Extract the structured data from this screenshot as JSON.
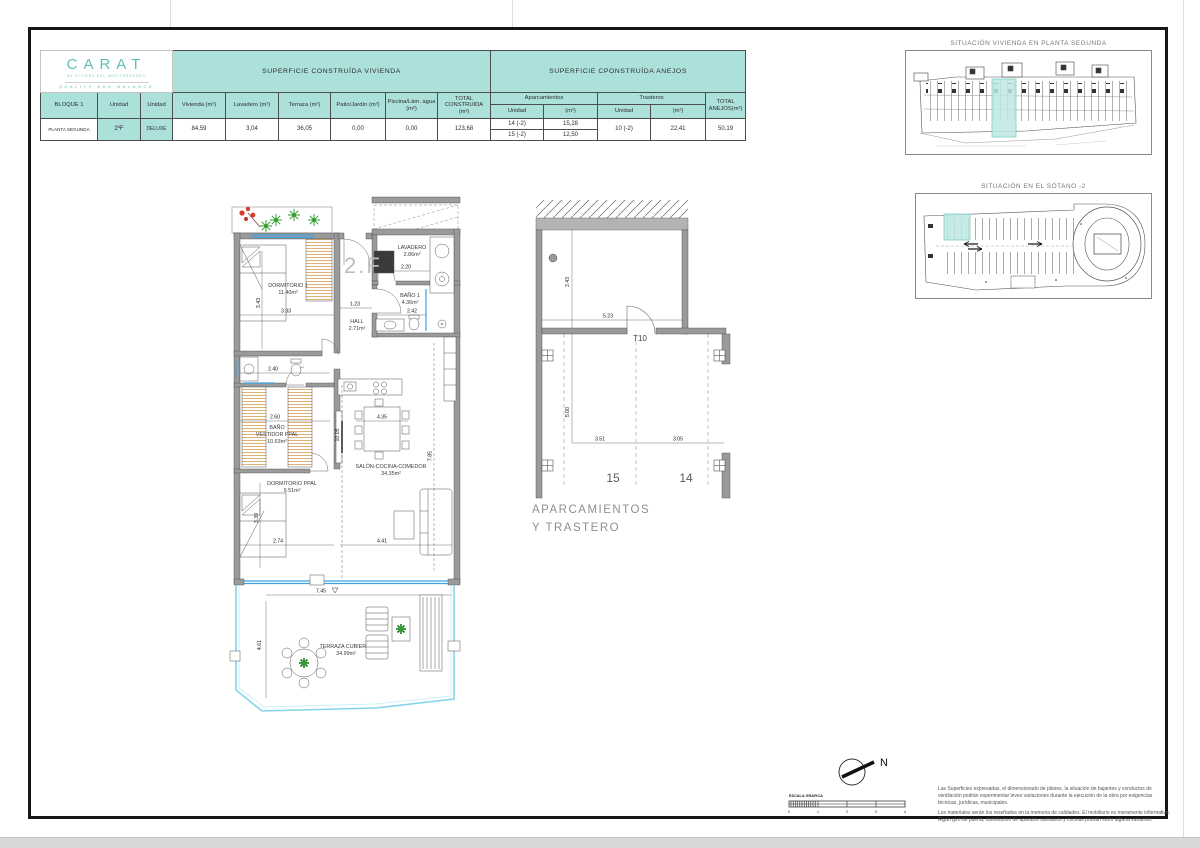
{
  "brand": {
    "name": "CARAT",
    "tagline": "BY RIVIERA DEL MEDITERRÁNEO",
    "motto": "QUALITY AND BALANCE"
  },
  "area_table": {
    "vivienda_title": "SUPERFICIE CONSTRUÍDA VIVIENDA",
    "anejos_title": "SUPERFICIE CPONSTRUÍDA ANEJOS",
    "headers": {
      "bloque": "BLOQUE 1",
      "unidad_a": "Unidad",
      "unidad_b": "Unidad",
      "vivienda": "Vivienda (m²)",
      "lavadero": "Lavadero (m²)",
      "terraza": "Terraza (m²)",
      "patio": "Patio/Jardín (m²)",
      "piscina": "Piscina/Lám. agua (m²)",
      "total_construida": "TOTAL CONSTRUIDA (m²)",
      "aparcamientos": "Aparcamientos",
      "trasteros": "Trasteros",
      "unidad": "Unidad",
      "m2": "(m²)",
      "total_anejos": "TOTAL ANEJOS(m²)"
    },
    "row": {
      "planta": "PLANTA SEGUNDA",
      "unidad": "2ºF",
      "tipo": "DELUXE",
      "vivienda": "84,59",
      "lavadero": "3,04",
      "terraza": "36,05",
      "patio": "0,00",
      "piscina": "0,00",
      "total_construida": "123,68",
      "aparcamiento1_unidad": "14 (-2)",
      "aparcamiento1_m2": "15,28",
      "aparcamiento2_unidad": "15 (-2)",
      "aparcamiento2_m2": "12,50",
      "trastero_unidad": "10 (-2)",
      "trastero_m2": "22,41",
      "total_anejos": "50,19"
    }
  },
  "floor_plan": {
    "unit_label": "2.F",
    "rooms": {
      "dormitorio1": {
        "name": "DORMITORIO 1",
        "area": "11.40m²"
      },
      "lavadero": {
        "name": "LAVADERO",
        "area": "2.86m²"
      },
      "bano1": {
        "name": "BAÑO 1",
        "area": "4.36m²"
      },
      "hall": {
        "name": "HALL",
        "area": "2.71m²"
      },
      "bano_vestidor": {
        "line1": "BAÑO",
        "line2": "VESTIDOR PPAL",
        "area": "10.63m²"
      },
      "dormitorio_ppal": {
        "name": "DORMITORIO PPAL",
        "area": "9.51m²"
      },
      "salon": {
        "name": "SALÓN-COCINA-COMEDOR",
        "area": "34.35m²"
      },
      "terraza": {
        "name": "TERRAZA CUBIERTA",
        "area": "34.99m²"
      }
    },
    "dims": {
      "dorm1_depth": "3.43",
      "dorm1_width": "3.33",
      "hall_width": "1.23",
      "lavadero_width": "2.20",
      "bano1_width": "2.42",
      "pasillo_width": "2.40",
      "vestidor_width": "2.60",
      "salon_depth": "10.05",
      "cocina_width": "4.35",
      "salon_right_depth": "7.85",
      "dormppal_depth": "3.39",
      "dormppal_width": "2.74",
      "salon_width": "4.41",
      "terraza_width": "7.45",
      "terraza_depth": "4.61"
    }
  },
  "parking_plan": {
    "trastero_label": "T10",
    "space_15": "15",
    "space_14": "14",
    "dims": {
      "trastero_width": "5.23",
      "trastero_depth": "3.43",
      "bay_depth": "5.00",
      "space15_width": "3.51",
      "space14_width": "3.05"
    },
    "caption_line1": "APARCAMIENTOS",
    "caption_line2": "Y TRASTERO"
  },
  "situation_planta": {
    "title": "SITUACIÓN VIVIENDA EN PLANTA SEGUNDA"
  },
  "situation_sotano": {
    "title": "SITUACIÓN EN EL SÓTANO -2"
  },
  "compass": {
    "label": "N"
  },
  "scale_bar": {
    "label": "ESCALA GRAFICA",
    "ticks": [
      "0",
      "1",
      "2",
      "3",
      "4"
    ]
  },
  "notes": {
    "p1": "Las Superficies expresadas, el dimensionado de pilares, la situación de bajantes y conductos de ventilación podrán experimentar leves variaciones durante la ejecución de la obra por exigencias técnicas, jurídicas, municipales.",
    "p2": "Los materiales serán los reseñados en la memoria de calidades. El mobiliario es meramente informativo. Algún giro de puerta, distribución de aparatos sanitarios y cocinas podrán sufrir alguna variación."
  },
  "colors": {
    "header_teal": "#ACE0DB",
    "brand_teal": "#5FBFB6",
    "highlight_teal": "#BEE9E4",
    "window_blue": "#3FA3E0",
    "terrace_blue": "#85D4E8",
    "plant_green": "#2F9E33",
    "flower_red": "#D43C30",
    "wall_gray": "#9A9A9A"
  }
}
